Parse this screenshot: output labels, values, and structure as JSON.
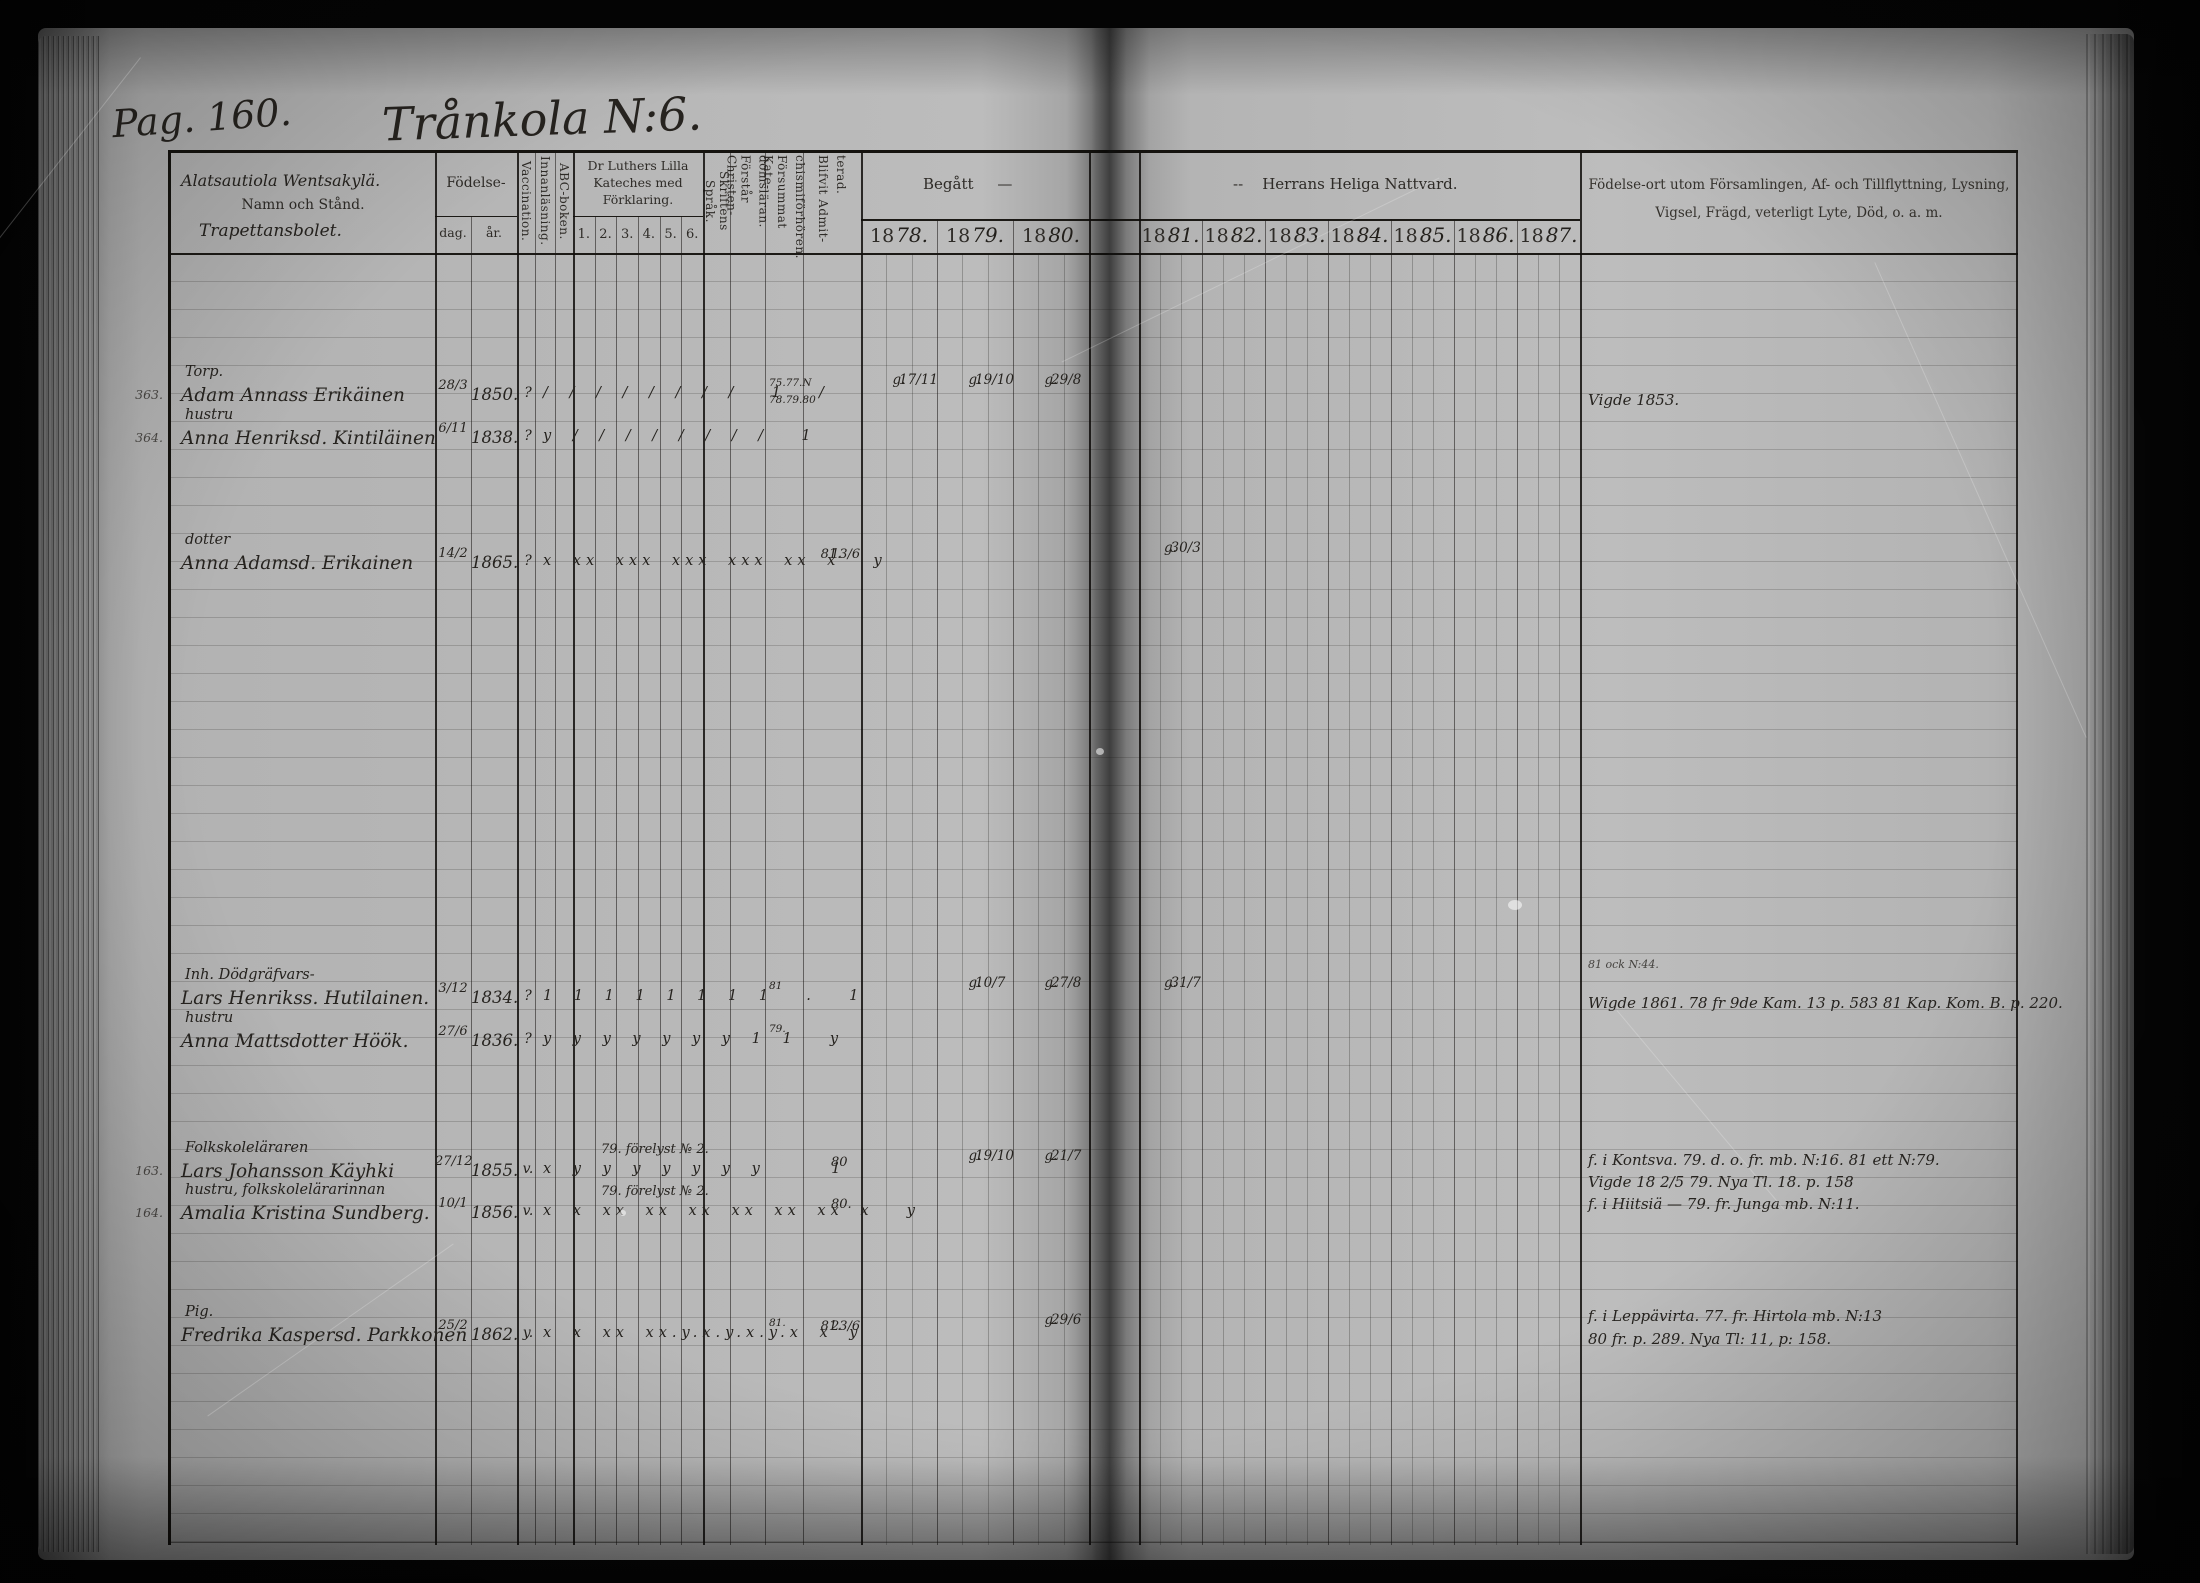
{
  "colors": {
    "paper": "#b5b5b5",
    "ink": "#26231f",
    "background": "#060606"
  },
  "page": {
    "label": "Pag. 160.",
    "title": "Trånkola N:6."
  },
  "header": {
    "name_hand": "Alatsautiola Wentsakylä.",
    "name_printed": "Namn och Stånd.",
    "name_hand2": "Trapettansbolet.",
    "fodelse": "Födelse-",
    "dag": "dag.",
    "ar": "år.",
    "vacc": "Vaccination.",
    "innan": "Innanläsning.",
    "abc": "ABC-boken.",
    "kateches": [
      "Dr Luthers Lilla",
      "Kateches med",
      "Förklaring."
    ],
    "kateches_nums": [
      "1.",
      "2.",
      "3.",
      "4.",
      "5.",
      "6."
    ],
    "sprak": "Skriftens Språk.",
    "forstar": [
      "Förstår Christen-",
      "domsläran."
    ],
    "forsummat": [
      "Försummat Kate-",
      "chismiförhören."
    ],
    "blifvit": [
      "Blifvit Admit-",
      "terad."
    ],
    "begatt": "Begått",
    "begatt_dash": "—",
    "nattvard_dash": "--",
    "nattvard": "Herrans Heliga Nattvard.",
    "years_left": [
      {
        "p": "18",
        "w": "78."
      },
      {
        "p": "18",
        "w": "79."
      },
      {
        "p": "18",
        "w": "80."
      }
    ],
    "years_right": [
      {
        "p": "18",
        "w": "81."
      },
      {
        "p": "18",
        "w": "82."
      },
      {
        "p": "18",
        "w": "83."
      },
      {
        "p": "18",
        "w": "84."
      },
      {
        "p": "18",
        "w": "85."
      },
      {
        "p": "18",
        "w": "86."
      },
      {
        "p": "18",
        "w": "87."
      }
    ],
    "notes1": "Födelse-ort utom Församlingen, Af- och Tillflyttning, Lysning,",
    "notes2": "Vigsel, Frägd, veterligt Lyte, Död, o. a. m."
  },
  "rows": [
    {
      "margin": "363.",
      "group": "Torp.",
      "name": "Adam Annass Erikäinen",
      "dag": "28/3",
      "ar": "1850.",
      "vacc": "?",
      "marks": "/ / / / / / / /  1  /",
      "forsum1": "75.77.N",
      "forsum2": "78.79.80",
      "n78": "17/11",
      "n78l": "g.",
      "n79": "19/10",
      "n79l": "g.",
      "n80": "29/8",
      "n80l": "g.",
      "note1": "Vigde 1853."
    },
    {
      "margin": "364.",
      "group": "hustru",
      "name": "Anna Henriksd. Kintiläinen",
      "dag": "6/11",
      "ar": "1838.",
      "vacc": "?",
      "marks": "y / / / / / / / /  1"
    },
    {
      "group": "dotter",
      "name": "Anna Adamsd. Erikainen",
      "dag": "14/2",
      "ar": "1865.",
      "vacc": "?",
      "marks": "x xx xxx xxx xxx xx x  y",
      "admit1": "13/6",
      "admit2": "81.",
      "n81": "30/3",
      "n81l": "g."
    },
    {
      "group": "Inh. Dödgräfvars-",
      "name": "Lars Henrikss. Hutilainen.",
      "dag": "3/12",
      "ar": "1834.",
      "vacc": "?",
      "marks": "1 1 1 1 1 1 1 1  .  1",
      "forsum1": "81",
      "n79": "10/7",
      "n79l": "g.",
      "n80": "27/8",
      "n80l": "g.",
      "n81": "31/7",
      "n81l": "g.",
      "note_sm": "81 ock N:44.",
      "note1": "Wigde 1861.  78 fr 9de Kam. 13 p. 583  81 Kap. Kom. B. p. 220."
    },
    {
      "group": "hustru",
      "name": "Anna Mattsdotter Höök.",
      "dag": "27/6",
      "ar": "1836.",
      "vacc": "?",
      "marks": "y y y y y y y 1 1  y",
      "forsum1": "79."
    },
    {
      "margin": "163.",
      "group": "Folkskoleläraren",
      "name": "Lars Johansson Käyhki",
      "dag": "27/12",
      "ar": "1855.",
      "vacc": "v.",
      "vaccnote": "79. förelyst № 2.",
      "marks": "x y y y y y y y    1",
      "admit1": "80",
      "n79": "19/10",
      "n79l": "g.",
      "n80": "21/7",
      "n80l": "g.",
      "note1": "f. i Kontsva.  79. d. o. fr. mb. N:16.  81 ett N:79.",
      "note2": "Vigde 18 2/5 79.  Nya Tl. 18. p. 158",
      "note3": "f. i Hiitsiä — 79. fr. Junga mb. N:11."
    },
    {
      "margin": "164.",
      "group": "hustru, folkskolelärarinnan",
      "name": "Amalia Kristina Sundberg.",
      "dag": "10/1",
      "ar": "1856.",
      "vacc": "v.",
      "vaccnote": "79. förelyst № 2.",
      "marks": "x x xx xx xx xx xx xx x  y",
      "admit1": "80."
    },
    {
      "group": "Pig.",
      "name": "Fredrika Kaspersd. Parkkonen",
      "dag": "25/2",
      "ar": "1862.",
      "vacc": "y.",
      "marks": "x x xx xx.y.x.y.x.y.x x y",
      "forsum1": "81.",
      "admit1": "23/6",
      "admit2": "81.",
      "n80": "29/6",
      "n80l": "g.",
      "note1": "f. i Leppävirta. 77. fr. Hirtola mb. N:13",
      "note2": "80 fr. p. 289.  Nya Tl: 11, p: 158."
    }
  ]
}
